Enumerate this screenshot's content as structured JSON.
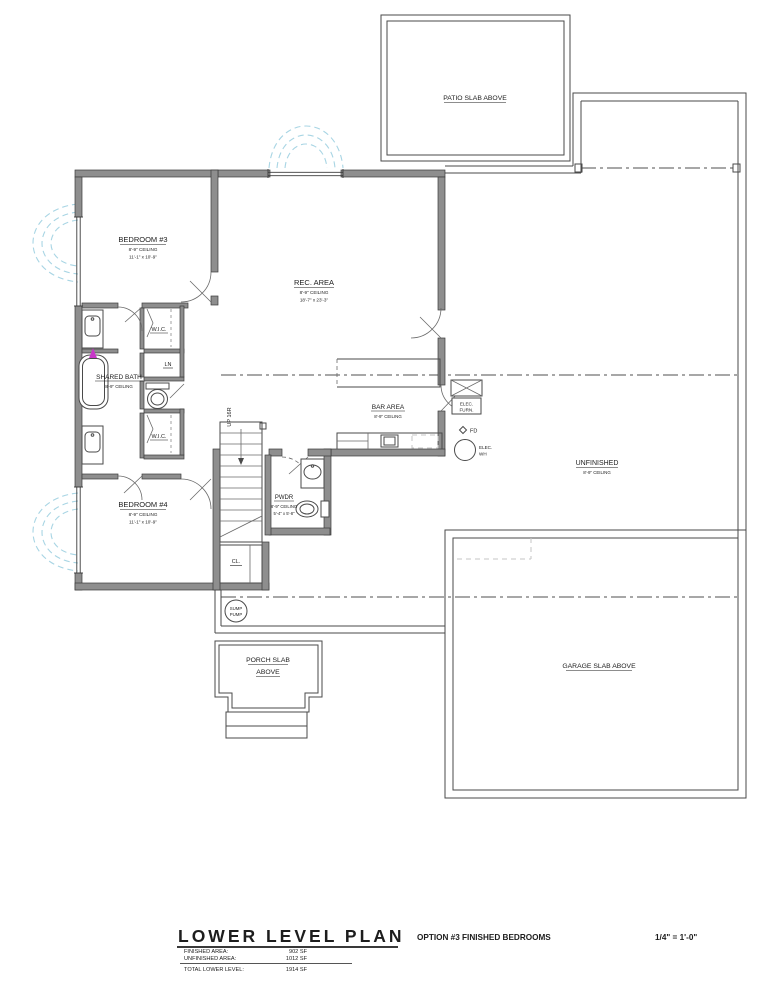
{
  "rooms": {
    "bedroom3": {
      "name": "BEDROOM #3",
      "ceiling": "8'-9\" CEILING",
      "dims": "11'-1\" x 10'-9\""
    },
    "rec_area": {
      "name": "REC. AREA",
      "ceiling": "8'-9\" CEILING",
      "dims": "18'-7\" x 23'-3\""
    },
    "shared_bath": {
      "name": "SHARED BATH",
      "ceiling": "8'-9\" CEILING"
    },
    "wic_top": {
      "name": "W.I.C."
    },
    "linen": {
      "name": "LN"
    },
    "wic_bottom": {
      "name": "W.I.C."
    },
    "bar_area": {
      "name": "BAR AREA",
      "ceiling": "8'-9\" CEILING"
    },
    "bedroom4": {
      "name": "BEDROOM #4",
      "ceiling": "8'-9\" CEILING",
      "dims": "11'-1\" x 10'-9\""
    },
    "pwdr": {
      "name": "PWDR",
      "ceiling": "8'-9\" CEILING",
      "dims": "5'-4\" x 5'-8\""
    },
    "unfinished": {
      "name": "UNFINISHED",
      "ceiling": "8'-9\" CEILING"
    },
    "closet": {
      "name": "CL."
    },
    "stairs": {
      "label": "UP 16R"
    }
  },
  "slabs": {
    "patio": "PATIO SLAB ABOVE",
    "garage": "GARAGE SLAB ABOVE",
    "porch": [
      "PORCH SLAB",
      "ABOVE"
    ]
  },
  "equipment": {
    "elec_furn": [
      "ELEC.",
      "FURN."
    ],
    "floor_drain": "FD",
    "elec_wh": [
      "ELEC.",
      "WH"
    ],
    "sump_pump": [
      "SUMP",
      "PUMP"
    ]
  },
  "title_block": {
    "title": "LOWER LEVEL PLAN",
    "option": "OPTION #3 FINISHED BEDROOMS",
    "scale": "1/4\" = 1'-0\"",
    "finished_label": "FINISHED AREA:",
    "finished_value": "902 SF",
    "unfinished_label": "UNFINISHED AREA:",
    "unfinished_value": "1012 SF",
    "total_label": "TOTAL LOWER LEVEL:",
    "total_value": "1914 SF"
  },
  "colors": {
    "wall_fill": "#8e8e8e",
    "wall_edge": "#3b3b3b",
    "window_well": "#a8d5e4",
    "marker": "#c837c8"
  }
}
